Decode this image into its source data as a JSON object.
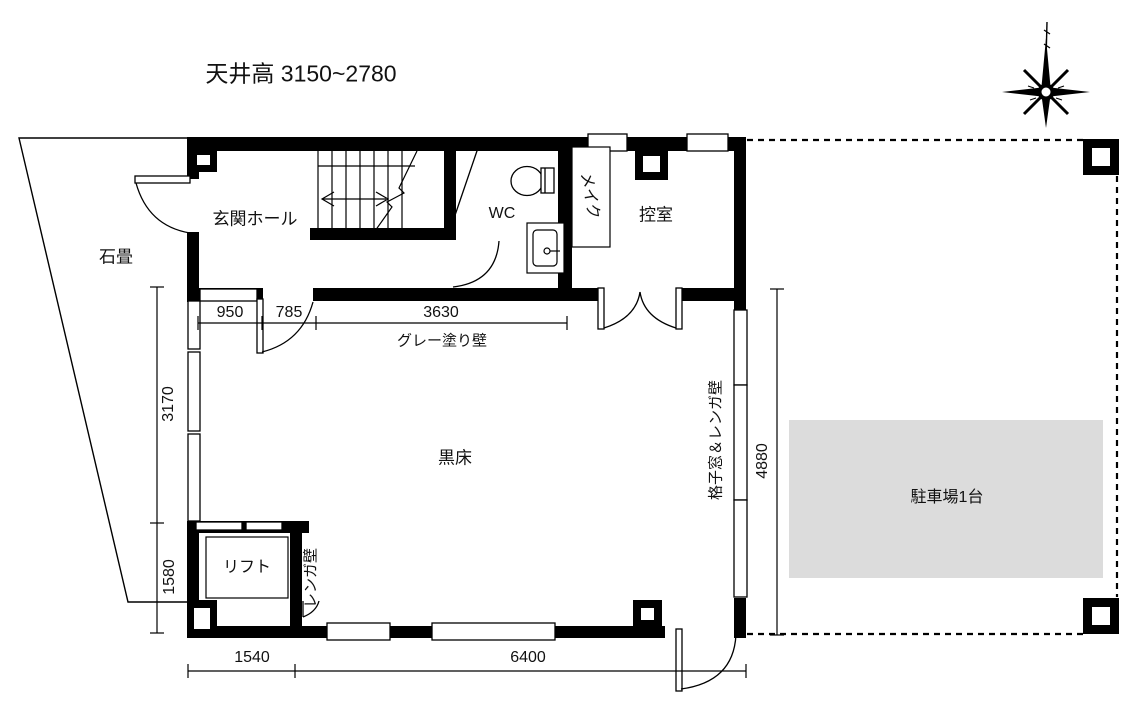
{
  "plan": {
    "note_ceiling": "天井高 3150~2780",
    "rooms": {
      "entrance_hall": "玄関ホール",
      "wc": "WC",
      "makeup": "メイク",
      "waiting_room": "控室",
      "black_floor": "黒床",
      "lift": "リフト"
    },
    "exterior": {
      "stone_pavement": "石畳",
      "parking": "駐車場1台"
    },
    "finishes": {
      "gray_painted_wall": "グレー塗り壁",
      "brick_wall": "レンガ壁",
      "lattice_window_brick_wall": "格子窓＆レンガ壁"
    },
    "dimensions": {
      "top_window": "950",
      "top_door": "785",
      "top_gray_wall": "3630",
      "left_upper": "3170",
      "left_lower": "1580",
      "right_height": "4880",
      "bottom_left": "1540",
      "bottom_main": "6400"
    },
    "colors": {
      "line": "#000000",
      "parking_fill": "#dcdcdc",
      "background": "#ffffff"
    }
  }
}
